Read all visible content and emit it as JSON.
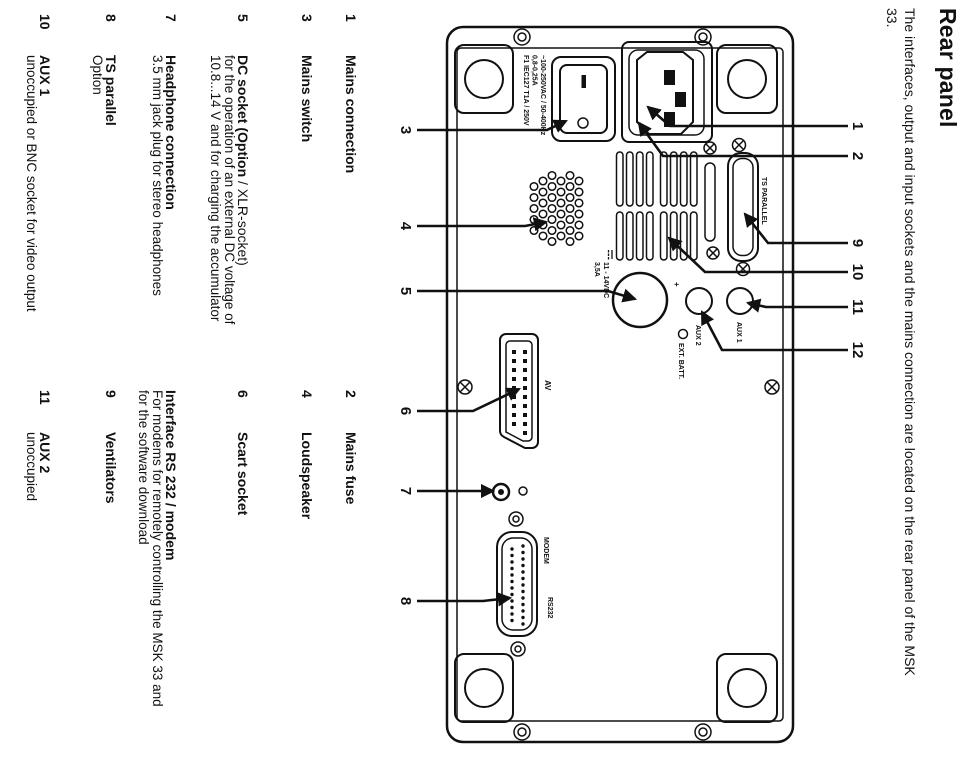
{
  "title": "Rear panel",
  "intro": {
    "line1": "The interfaces, output and input sockets and the mains connection are located on the rear panel of the MSK",
    "line2": "33."
  },
  "legend": {
    "col1": [
      {
        "num": "1",
        "label": "Mains connection",
        "suffix": "",
        "desc": []
      },
      {
        "num": "3",
        "label": "Mains switch",
        "suffix": "",
        "desc": []
      },
      {
        "num": "5",
        "label": "DC socket (Option",
        "suffix": " / XLR-socket)",
        "desc": [
          "for the operation of an external DC voltage of",
          "10.8...14 V and for charging the accumulator"
        ]
      },
      {
        "num": "7",
        "label": "Headphone connection",
        "suffix": "",
        "desc": [
          "3.5 mm jack plug for stereo headphones"
        ]
      },
      {
        "num": "8",
        "label": "TS parallel",
        "suffix": "",
        "desc": [
          "Option"
        ]
      },
      {
        "num": "10",
        "label": "AUX 1",
        "suffix": "",
        "desc": [
          "unoccupied or BNC socket for video output"
        ]
      }
    ],
    "col2": [
      {
        "num": "2",
        "label": "Mains fuse",
        "desc": []
      },
      {
        "num": "4",
        "label": "Loudspeaker",
        "desc": []
      },
      {
        "num": "6",
        "label": "Scart socket",
        "desc": []
      },
      {
        "num": "",
        "label": "Interface RS 232 / modem",
        "desc": [
          "For modems for remotely controlling the MSK 33 and",
          "for the software download"
        ]
      },
      {
        "num": "9",
        "label": "Ventilators",
        "desc": []
      },
      {
        "num": "11",
        "label": "AUX 2",
        "desc": [
          "unoccupied"
        ]
      }
    ]
  },
  "diagram": {
    "labels": {
      "mains1": "~100-250VAC / 50-400Hz",
      "mains2": "0,8-0,25A",
      "mains3": "F1 IEC127 T1A / 250V",
      "ts_parallel": "TS PARALLEL",
      "dc1": "11 - 14VDC",
      "dc2": "3,5A",
      "plus": "+",
      "aux1": "AUX 1",
      "aux2": "AUX 2",
      "ext_batt": "EXT. BATT.",
      "av": "AV",
      "modem": "MODEM",
      "rs232": "RS232"
    },
    "callouts_left": [
      "3",
      "4",
      "5",
      "6",
      "7",
      "8"
    ],
    "callouts_right": [
      "1",
      "2",
      "9",
      "10",
      "11",
      "12"
    ]
  }
}
